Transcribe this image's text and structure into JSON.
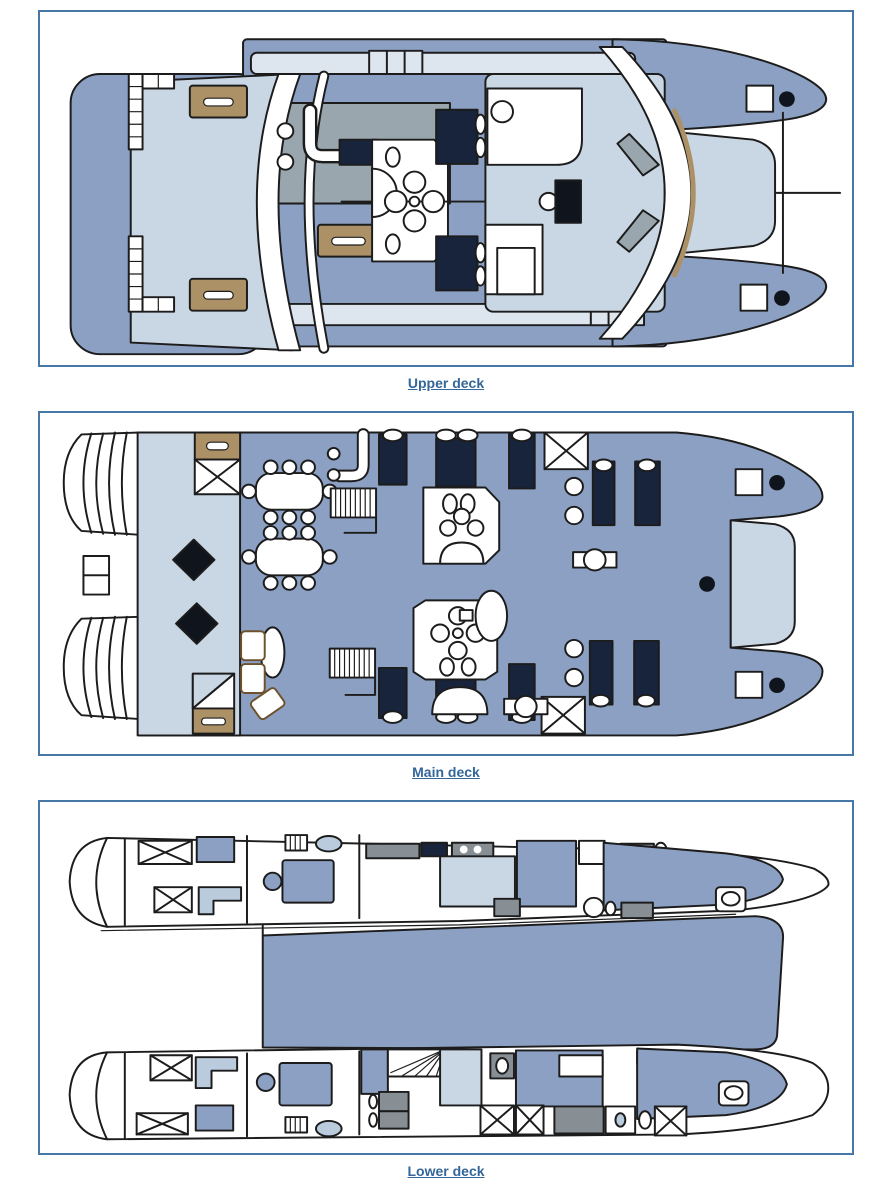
{
  "palette": {
    "frame_border": "#4677a6",
    "link": "#336699",
    "hull": "#8ba0c2",
    "deck_light": "#c9d6e3",
    "band": "#dde5ee",
    "gray": "#9aa6ae",
    "furniture_gray": "#878f94",
    "tan": "#ad9166",
    "navy": "#17243b",
    "counter_light": "#b9cbdc",
    "outline": "#1c1c1c",
    "background": "#ffffff"
  },
  "decks": [
    {
      "id": "upper",
      "caption": "Upper deck"
    },
    {
      "id": "main",
      "caption": "Main deck"
    },
    {
      "id": "lower",
      "caption": "Lower deck"
    }
  ]
}
